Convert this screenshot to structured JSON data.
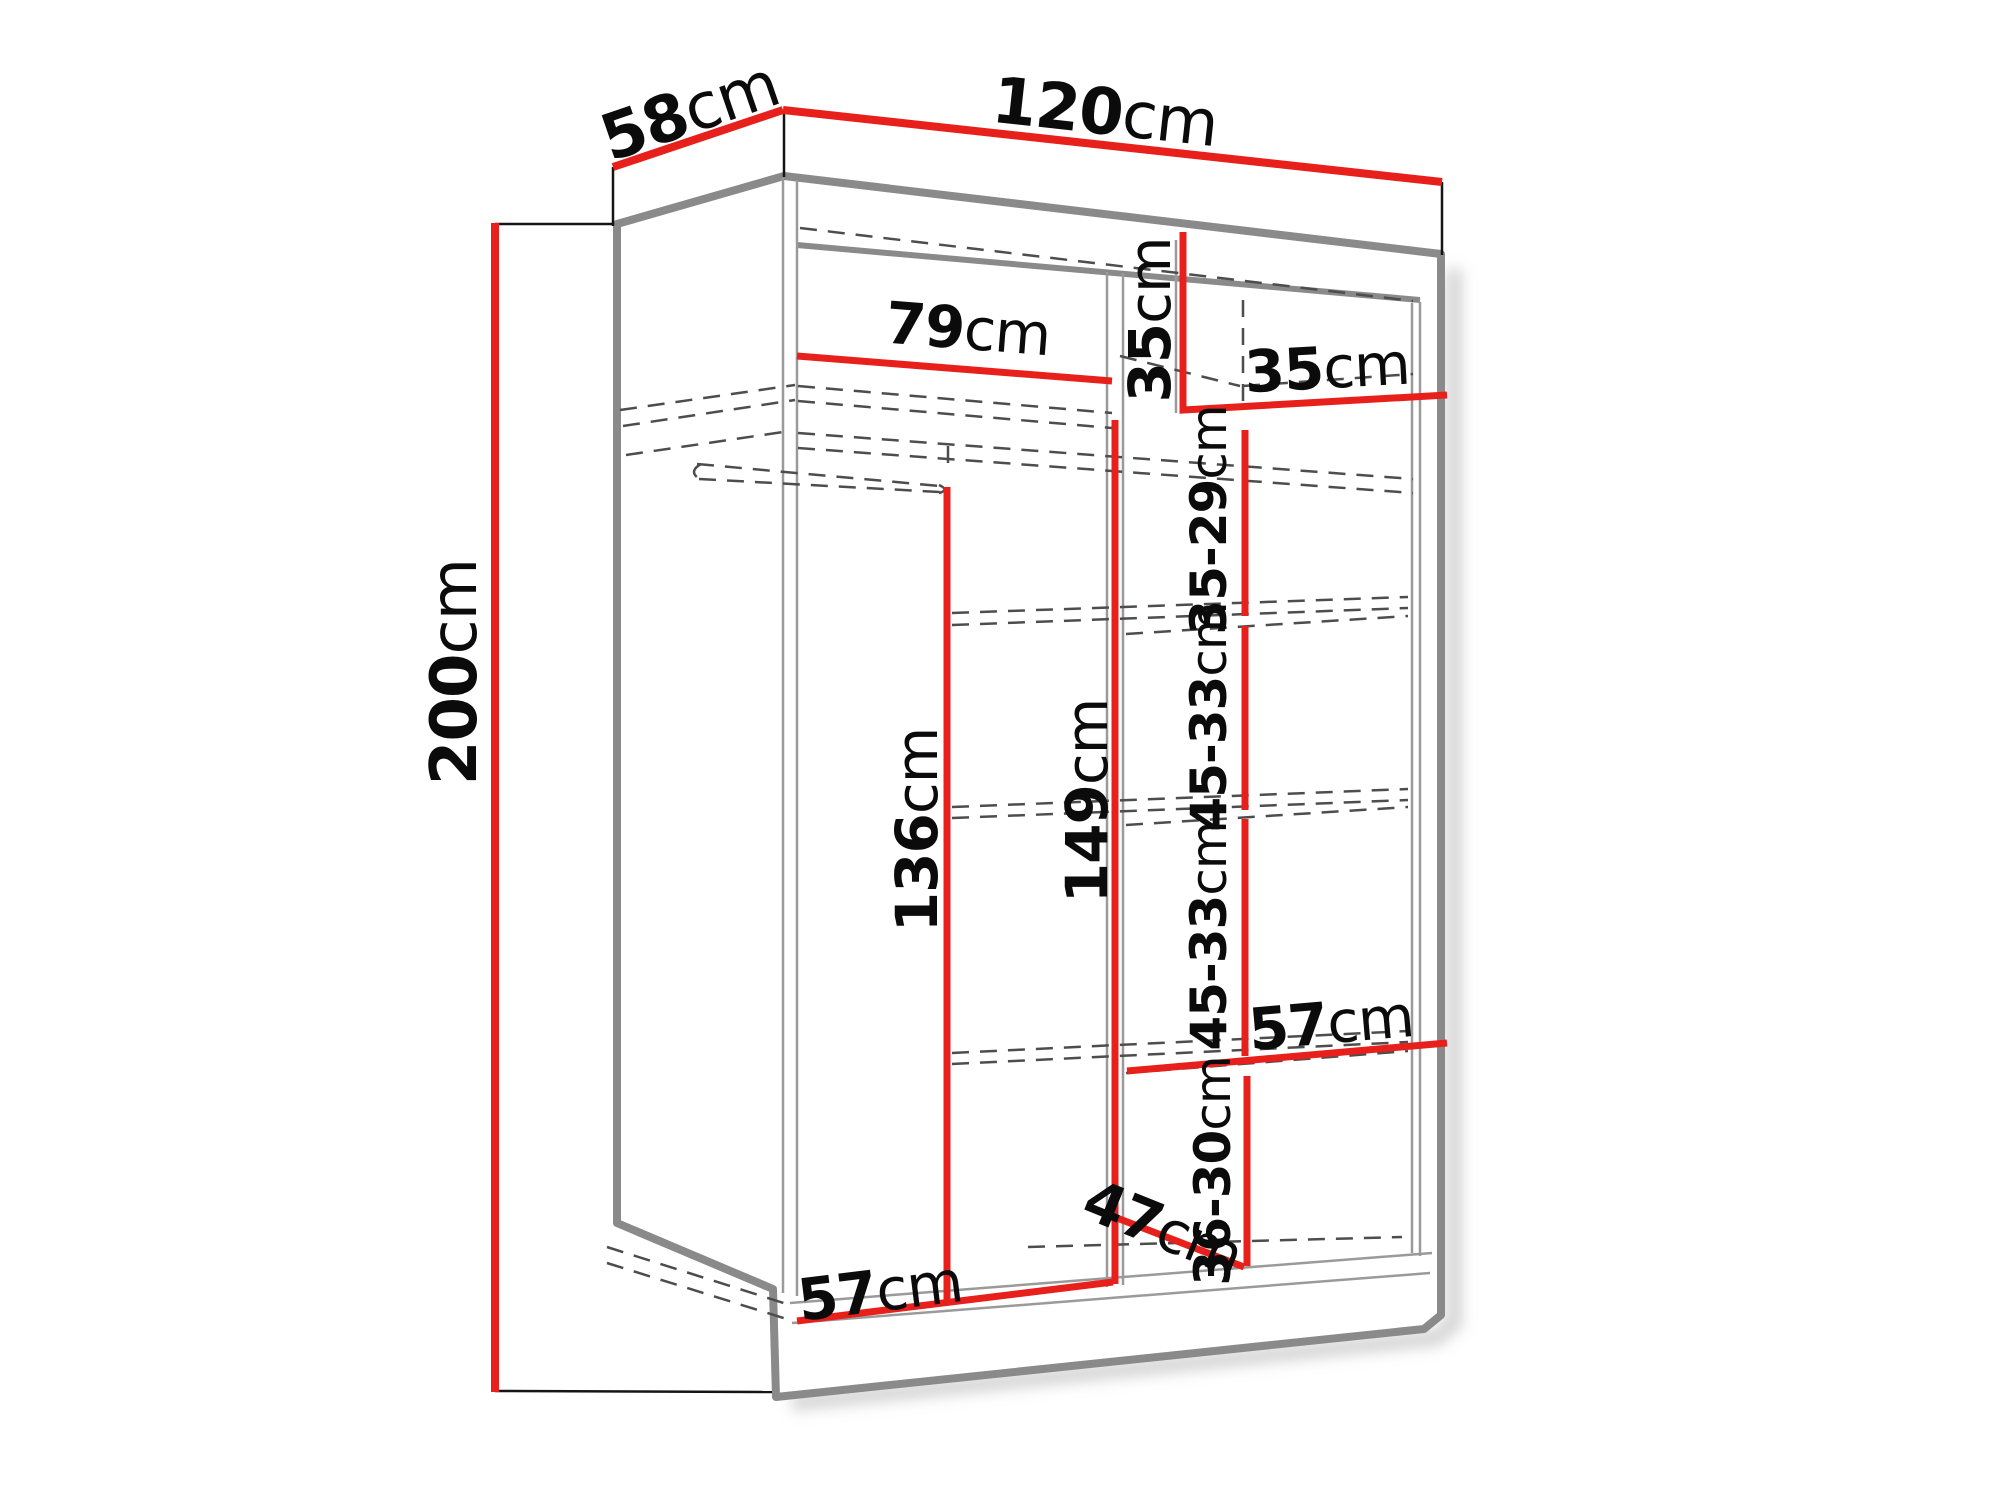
{
  "diagram": {
    "object": "wardrobe-interior-dimension-drawing",
    "unit": "cm",
    "background": "#ffffff",
    "colors": {
      "dimension_line": "#e8201c",
      "outline": "#8a8a8a",
      "hidden_edge": "#4d4d4d",
      "label_text": "#0b0b0b"
    },
    "labels": {
      "depth": {
        "num": "58",
        "unit": "cm"
      },
      "width": {
        "num": "120",
        "unit": "cm"
      },
      "height": {
        "num": "200",
        "unit": "cm"
      },
      "top_left_section_width": {
        "num": "79",
        "unit": "cm"
      },
      "top_right_section_height": {
        "num": "35",
        "unit": "cm"
      },
      "top_right_section_width": {
        "num": "35",
        "unit": "cm"
      },
      "shelf_space_1": {
        "num": "35-29",
        "unit": "cm"
      },
      "shelf_space_2": {
        "num": "45-33",
        "unit": "cm"
      },
      "shelf_space_3": {
        "num": "45-33",
        "unit": "cm"
      },
      "middle_shelf_width": {
        "num": "57",
        "unit": "cm"
      },
      "shelf_space_4": {
        "num": "36-30",
        "unit": "cm"
      },
      "bottom_diagonal": {
        "num": "47",
        "unit": "cm"
      },
      "hanging_section_height": {
        "num": "136",
        "unit": "cm"
      },
      "right_column_height": {
        "num": "149",
        "unit": "cm"
      },
      "bottom_shelf_width": {
        "num": "57",
        "unit": "cm"
      }
    }
  }
}
